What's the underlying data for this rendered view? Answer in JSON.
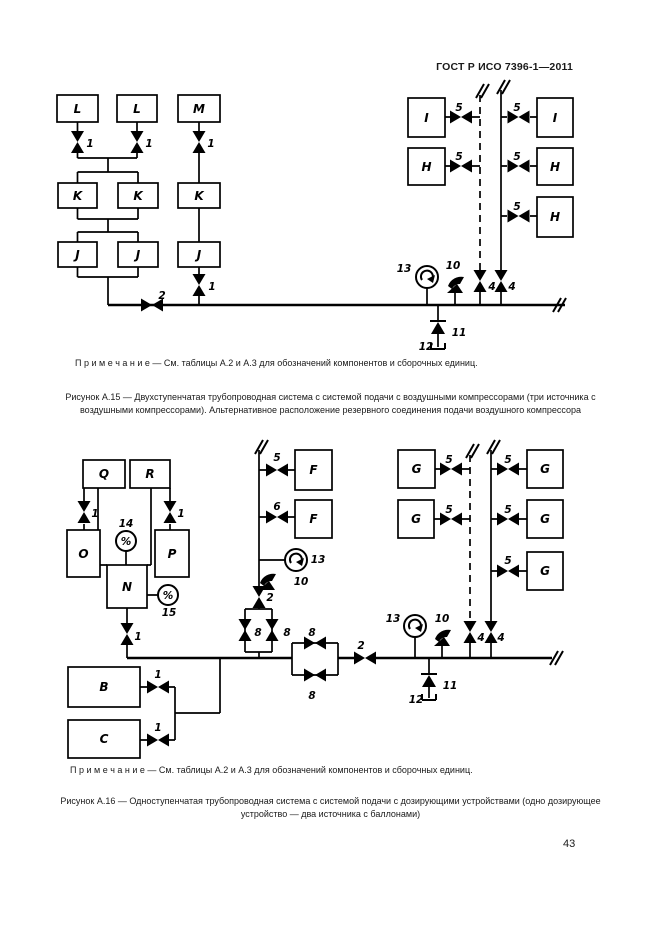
{
  "header": {
    "title": "ГОСТ Р ИСО 7396-1—2011"
  },
  "page_number": "43",
  "fig15": {
    "note": "П р и м е ч а н и е — См. таблицы А.2 и А.3 для обозначений компонентов и сборочных единиц.",
    "caption": "Рисунок А.15 — Двухступенчатая трубопроводная система с системой подачи с воздушными компрессорами (три источника с воздушными компрессорами). Альтернативное расположение резервного соединения подачи воздушного компрессора",
    "boxes": {
      "L": "L",
      "M": "M",
      "K": "K",
      "J": "J",
      "I": "I",
      "H": "H"
    }
  },
  "fig16": {
    "note": "П р и м е ч а н и е — См. таблицы А.2 и А.3 для обозначений компонентов и сборочных единиц.",
    "caption": "Рисунок А.16 — Одноступенчатая трубопроводная система с системой подачи с дозирующими устройствами (одно дозирующее устройство — два источника с баллонами)",
    "boxes": {
      "Q": "Q",
      "R": "R",
      "O": "O",
      "P": "P",
      "N": "N",
      "F": "F",
      "G": "G",
      "B": "B",
      "C": "C"
    }
  },
  "labels": {
    "v1": "1",
    "v2": "2",
    "v4": "4",
    "v5": "5",
    "v6": "6",
    "v8": "8",
    "c10": "10",
    "c11": "11",
    "c12": "12",
    "c13": "13",
    "c14": "14",
    "c15": "15",
    "percent": "%"
  }
}
